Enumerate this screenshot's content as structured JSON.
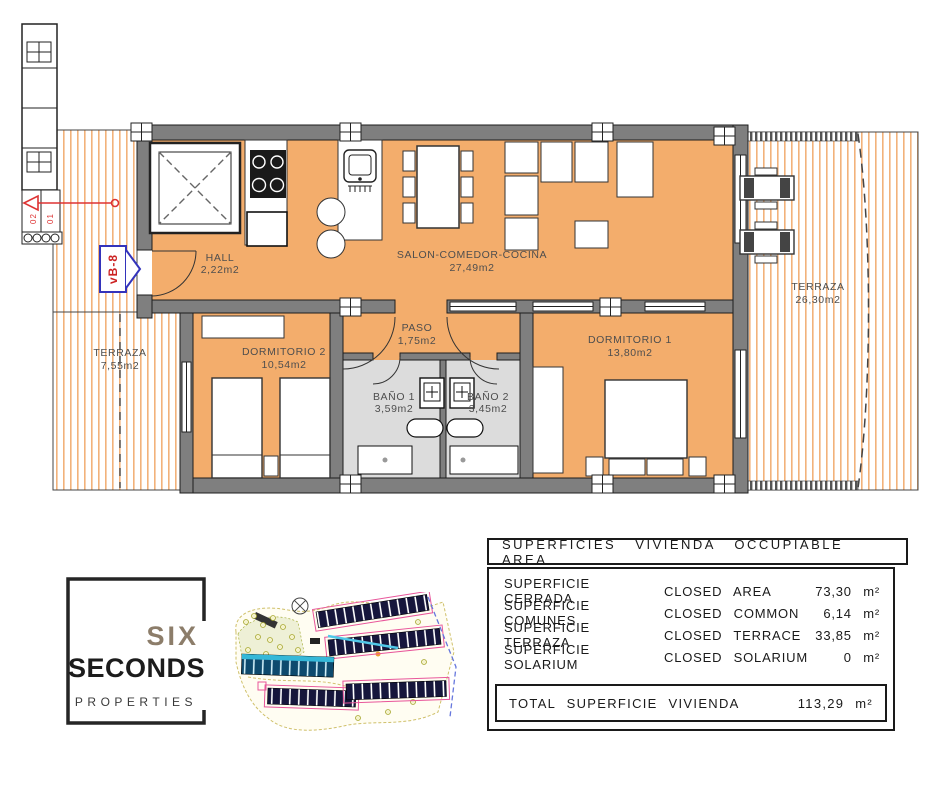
{
  "plan": {
    "unit_marker": "vB-8",
    "stair_labels": {
      "upper": "02",
      "lower": "01"
    },
    "rooms": {
      "hall": {
        "name": "HALL",
        "area": "2,22m2"
      },
      "salon": {
        "name": "SALON-COMEDOR-COCINA",
        "area": "27,49m2"
      },
      "paso": {
        "name": "PASO",
        "area": "1,75m2"
      },
      "dormitorio2": {
        "name": "DORMITORIO 2",
        "area": "10,54m2"
      },
      "dormitorio1": {
        "name": "DORMITORIO 1",
        "area": "13,80m2"
      },
      "bano1": {
        "name": "BAÑO 1",
        "area": "3,59m2"
      },
      "bano2": {
        "name": "BAÑO 2",
        "area": "3,45m2"
      },
      "terraza_right": {
        "name": "TERRAZA",
        "area": "26,30m2"
      },
      "terraza_left": {
        "name": "TERRAZA",
        "area": "7,55m2"
      }
    },
    "colors": {
      "floor": "#f3ad6c",
      "wall": "#7f7f7f",
      "bath_floor": "#dcdcdc",
      "terrace_stripe": "#f2b27a",
      "marker_blue": "#3333bb",
      "marker_red": "#cc2222"
    }
  },
  "logo": {
    "word1": "SIX",
    "word2": "SECONDS",
    "word3": "PROPERTIES"
  },
  "areas_table": {
    "title": "SUPERFICIES VIVIENDA OCCUPIABLE AREA",
    "rows": [
      {
        "label_es": "SUPERFICIE CERRADA",
        "label_en": "CLOSED AREA",
        "value": "73,30 m²"
      },
      {
        "label_es": "SUPERFICIE COMUNES",
        "label_en": "CLOSED COMMON",
        "value": "6,14 m²"
      },
      {
        "label_es": "SUPERFICIE TERRAZA",
        "label_en": "CLOSED TERRACE",
        "value": "33,85 m²"
      },
      {
        "label_es": "SUPERFICIE SOLARIUM",
        "label_en": "CLOSED SOLARIUM",
        "value": "0 m²"
      }
    ],
    "total_label": "TOTAL SUPERFICIE VIVIENDA",
    "total_value": "113,29 m²"
  }
}
